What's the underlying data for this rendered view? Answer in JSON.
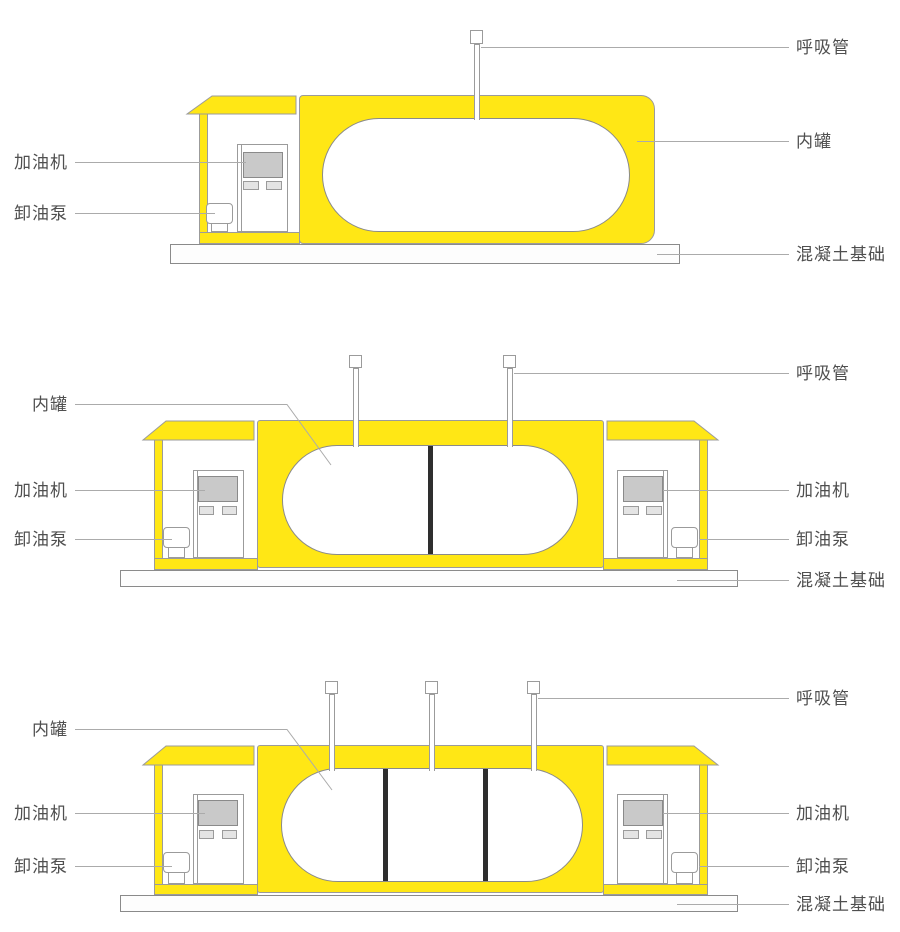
{
  "labels": {
    "breather_pipe": "呼吸管",
    "inner_tank": "内罐",
    "fuel_dispenser": "加油机",
    "unloading_pump": "卸油泵",
    "concrete_foundation": "混凝土基础"
  },
  "diagrams": [
    {
      "position": "top",
      "compartments": 1,
      "breather_pipes": 1,
      "pump_cabins": 1,
      "fuel_dispensers": 1,
      "unloading_pumps": 1
    },
    {
      "position": "middle",
      "compartments": 2,
      "breather_pipes": 2,
      "pump_cabins": 2,
      "fuel_dispensers": 2,
      "unloading_pumps": 2
    },
    {
      "position": "bottom",
      "compartments": 3,
      "breather_pipes": 3,
      "pump_cabins": 2,
      "fuel_dispensers": 2,
      "unloading_pumps": 2
    }
  ],
  "colors": {
    "yellow": "#FFE715",
    "outline": "#9B9B9B",
    "tank_outline": "#8A8A8A",
    "divider": "#2E2E2E",
    "leader": "#ABABAB",
    "text": "#4F4F4F",
    "screen": "#C9C9C9",
    "button": "#E4E4E4",
    "foundation": "#FDFDFD"
  }
}
